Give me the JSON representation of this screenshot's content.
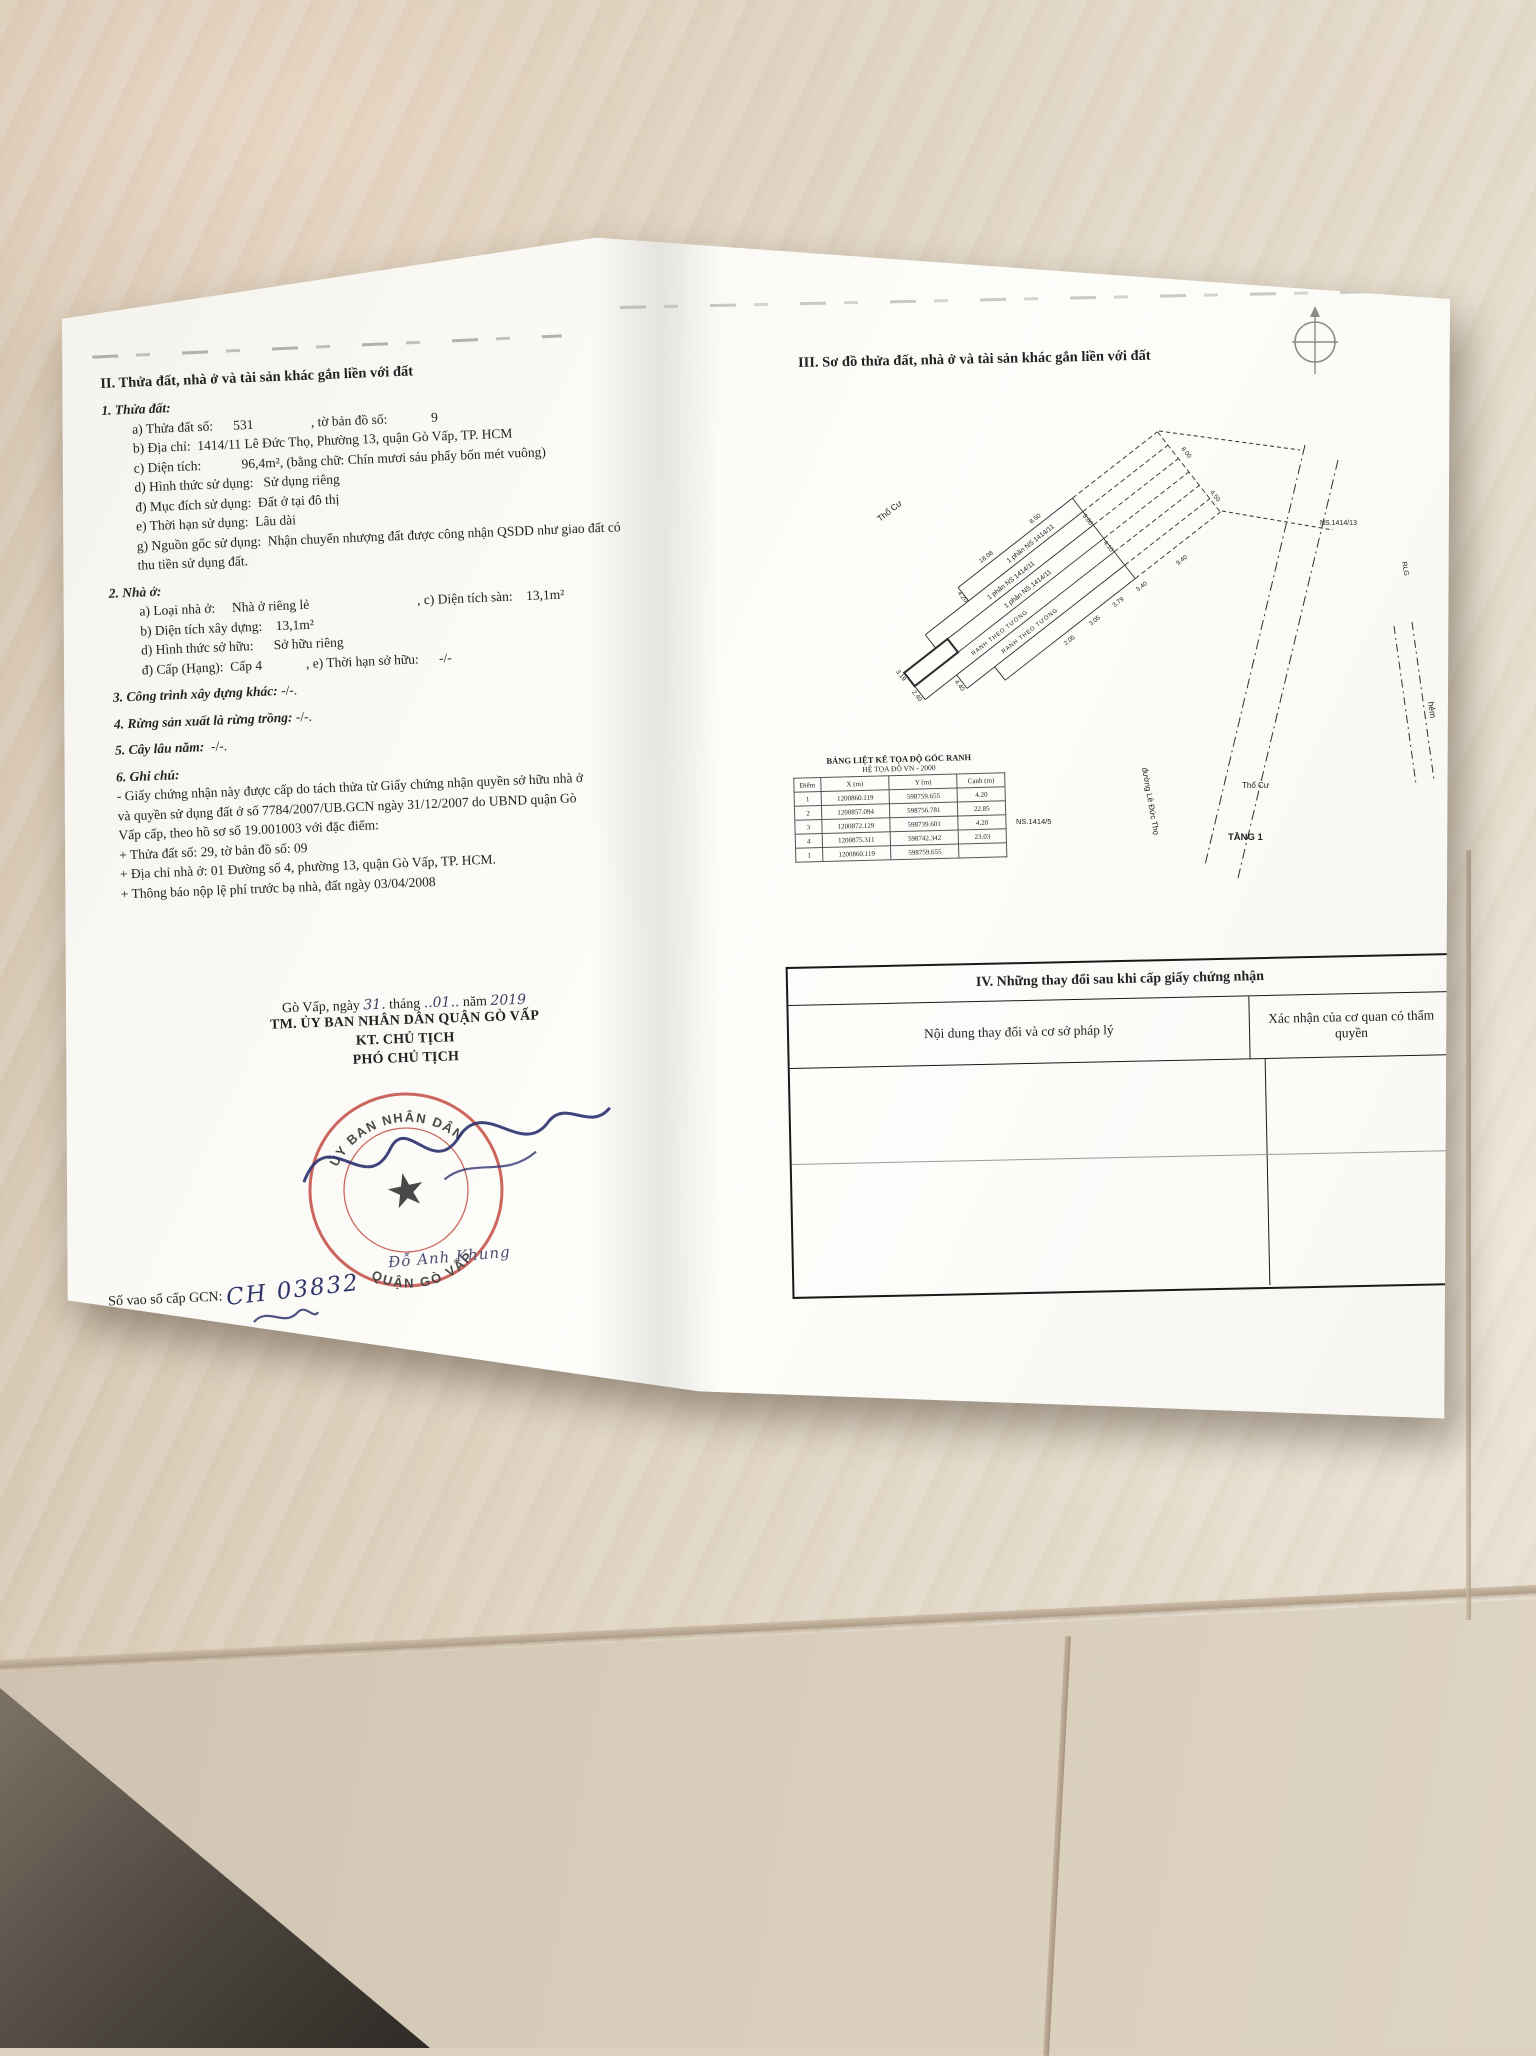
{
  "left_page": {
    "section2_heading": "II. Thửa đất, nhà ở và tài sản khác gắn liền với đất",
    "s1_heading": "1. Thửa đất:",
    "s1": {
      "a": "a) Thửa đất số:      531                 , tờ bản đồ số:             9",
      "b": "b) Địa chỉ:  1414/11 Lê Đức Thọ, Phường 13, quận Gò Vấp, TP. HCM",
      "c": "c) Diện tích:            96,4m², (bằng chữ: Chín mươi sáu phẩy bốn mét vuông)",
      "d": "d) Hình thức sử dụng:   Sử dụng riêng",
      "dd": "đ) Mục đích sử dụng:  Đất ở tại đô thị",
      "e": "e) Thời hạn sử dụng:  Lâu dài",
      "g1": "g) Nguồn gốc sử dụng:  Nhận chuyển nhượng đất được công nhận QSDD như giao đất có",
      "g2": "thu tiền sử dụng đất."
    },
    "s2_heading": "2. Nhà ở:",
    "s2": {
      "a": "a) Loại nhà ở:     Nhà ở riêng lẻ                                , c) Diện tích sàn:    13,1m²",
      "b": "b) Diện tích xây dựng:    13,1m²",
      "d": "d) Hình thức sở hữu:      Sở hữu riêng",
      "dd": "đ) Cấp (Hạng):  Cấp 4             , e) Thời hạn sở hữu:      -/-"
    },
    "s3_heading": "3. Công trình xây dựng khác:",
    "s3_value": "-/-.",
    "s4_heading": "4. Rừng sản xuất là rừng trồng:",
    "s4_value": "-/-.",
    "s5_heading": "5. Cây lâu năm:",
    "s5_value": "-/-.",
    "s6_heading": "6. Ghi chú:",
    "note": {
      "l1": "- Giấy chứng nhận này được cấp do tách thửa từ Giấy chứng nhận quyền sở hữu nhà ở",
      "l2": "và quyền sử dụng đất ở số 7784/2007/UB.GCN ngày 31/12/2007 do UBND quận Gò",
      "l3": "Vấp cấp, theo hồ sơ số 19.001003 với đặc điểm:",
      "l4": "+ Thửa đất số: 29, tờ bản đồ số: 09",
      "l5": "+ Địa chỉ nhà ở: 01 Đường số 4, phường 13, quận Gò Vấp, TP. HCM.",
      "l6": "+ Thông báo nộp lệ phí trước bạ nhà, đất ngày 03/04/2008"
    },
    "sign": {
      "date_pre": "Gò Vấp, ngày ",
      "date_day": "31.",
      "date_mid1": " tháng ",
      "date_month": "..01..",
      "date_mid2": " năm ",
      "date_year": "2019",
      "org": "TM. ỦY BAN NHÂN DÂN QUẬN GÒ VẤP",
      "kt": "KT. CHỦ TỊCH",
      "pct": "PHÓ CHỦ TỊCH",
      "signer": "Đỗ Anh Khung"
    },
    "stamp": {
      "ring_top": "ỦY BAN NHÂN DÂN",
      "ring_bottom": "QUẬN GÒ VẤP",
      "star": "★",
      "color": "#c4463e"
    },
    "gcn_label": "Số vao sổ cấp GCN:",
    "gcn_comma": ",",
    "gcn_value": "CH 03832"
  },
  "right_page": {
    "section3_heading": "III. Sơ đồ thửa đất, nhà ở và tài sản khác gắn liền với đất",
    "coords": {
      "title1": "BẢNG LIỆT KÊ TỌA ĐỘ GÓC RANH",
      "title2": "HỆ TỌA ĐỘ VN - 2000",
      "headers": [
        "Điểm",
        "X (m)",
        "Y (m)",
        "Cạnh (m)"
      ],
      "rows": [
        [
          "1",
          "1200860.119",
          "598759.655",
          "4.20"
        ],
        [
          "2",
          "1200857.094",
          "598756.781",
          "22.85"
        ],
        [
          "3",
          "1200872.129",
          "598739.601",
          "4.20"
        ],
        [
          "4",
          "1200875.311",
          "598742.342",
          "23.03"
        ],
        [
          "1",
          "1200860.119",
          "598759.655",
          ""
        ]
      ]
    },
    "diagram": {
      "labels": {
        "tho_cu_1": "Thổ Cư",
        "tho_cu_2": "Thổ Cư",
        "phan_ns_1": "1 phần NS  1414/11",
        "phan_ns_2": "1 phần NS  1414/11",
        "phan_ns_3": "1 phần NS  1414/11",
        "ranh_1": "RANH THEO TƯỜNG",
        "ranh_2": "RANH THEO TƯỜNG",
        "ns_1414_13": "NS.1414/13",
        "ns_1414_5": "NS.1414/5",
        "rlg": "RLG",
        "hem": "hẻm",
        "tang_1": "TẦNG 1",
        "road": "đường Lê Đức Thọ"
      },
      "dims": {
        "a": "18.08",
        "b": "8.50",
        "c": "3.19",
        "d": "2.40",
        "e": "4.40",
        "f": "4.20",
        "g": "5.00",
        "h": "4.10",
        "i": "2.05",
        "j": "3.05",
        "k": "3.79",
        "l": "3.40",
        "m": "8.00",
        "n": "4.50",
        "o": "9.40"
      }
    },
    "table4": {
      "title": "IV. Những thay đổi sau khi cấp giấy chứng nhận",
      "col1": "Nội dung thay đổi và cơ sở pháp lý",
      "col2": "Xác nhận của cơ quan có thẩm quyền"
    }
  }
}
